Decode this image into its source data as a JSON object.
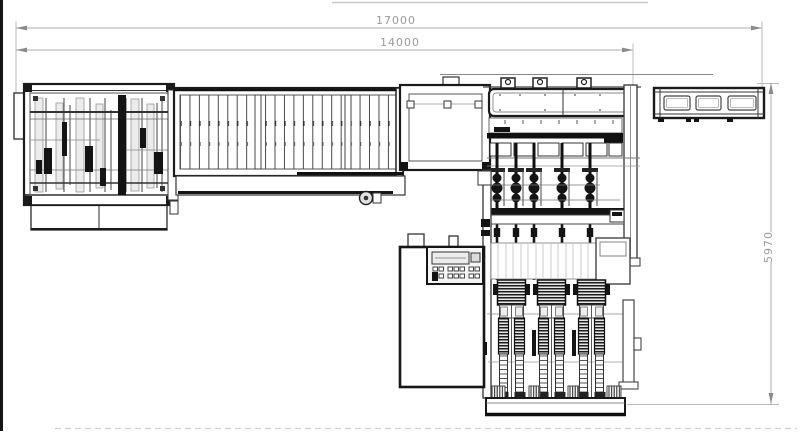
{
  "dimensions": {
    "overall_length": "17000",
    "infeed_length": "14000",
    "machine_depth": "5970"
  },
  "colors": {
    "background": "#ffffff",
    "line": "#2b2b2b",
    "dark_fill": "#141414",
    "dim_line": "#aeaeae",
    "dim_text": "#9a9a9a"
  }
}
